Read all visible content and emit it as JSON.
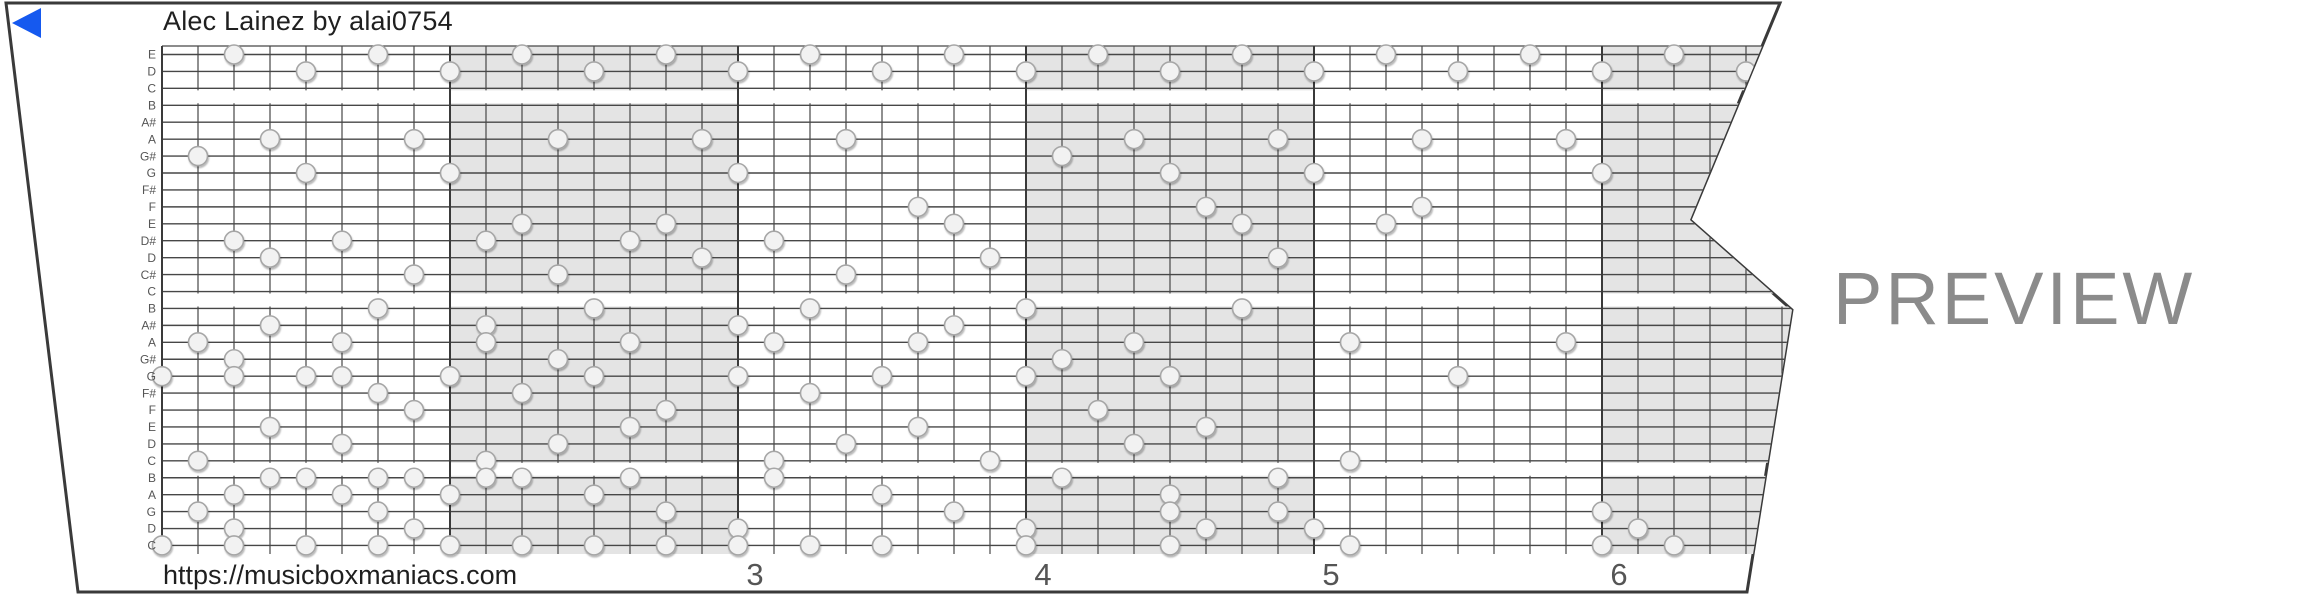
{
  "header": {
    "title": "Alec Lainez by alai0754"
  },
  "footer": {
    "url": "https://musicboxmaniacs.com"
  },
  "watermark": {
    "label": "PREVIEW",
    "color": "#8b8b8b"
  },
  "player": {
    "icon": "play-triangle-icon",
    "color": "#1559ef"
  },
  "strip": {
    "note_labels": [
      "E",
      "D",
      "C",
      "B",
      "A#",
      "A",
      "G#",
      "G",
      "F#",
      "F",
      "E",
      "D#",
      "D",
      "C#",
      "C",
      "B",
      "A#",
      "A",
      "G#",
      "G",
      "F#",
      "F",
      "E",
      "D",
      "C",
      "B",
      "A",
      "G",
      "D",
      "C"
    ],
    "measure_numbers": [
      {
        "label": "3",
        "beat": 16
      },
      {
        "label": "4",
        "beat": 24
      },
      {
        "label": "5",
        "beat": 32
      },
      {
        "label": "6",
        "beat": 40
      }
    ],
    "shaded_measure_starts": [
      8,
      24,
      40
    ],
    "octave_gap_after_rows": [
      2,
      14,
      24
    ],
    "colors": {
      "shade": "#e4e4e4",
      "line": "#474747",
      "measure_line": "#3a3a3a",
      "border": "#3a3a3a",
      "note_fill": "#f2f2f2",
      "note_stroke": "#a6a6a6",
      "label_text": "#555555",
      "number_text": "#555555"
    },
    "notes": [
      [
        0,
        2
      ],
      [
        0,
        6
      ],
      [
        0,
        10
      ],
      [
        0,
        14
      ],
      [
        0,
        18
      ],
      [
        0,
        22
      ],
      [
        0,
        26
      ],
      [
        0,
        30
      ],
      [
        0,
        34
      ],
      [
        0,
        38
      ],
      [
        0,
        42
      ],
      [
        1,
        4
      ],
      [
        1,
        8
      ],
      [
        1,
        12
      ],
      [
        1,
        16
      ],
      [
        1,
        20
      ],
      [
        1,
        24
      ],
      [
        1,
        28
      ],
      [
        1,
        32
      ],
      [
        1,
        36
      ],
      [
        1,
        40
      ],
      [
        1,
        44
      ],
      [
        5,
        3
      ],
      [
        5,
        7
      ],
      [
        5,
        11
      ],
      [
        5,
        15
      ],
      [
        5,
        19
      ],
      [
        5,
        27
      ],
      [
        5,
        31
      ],
      [
        5,
        35
      ],
      [
        5,
        39
      ],
      [
        6,
        1
      ],
      [
        6,
        25
      ],
      [
        7,
        4
      ],
      [
        7,
        8
      ],
      [
        7,
        16
      ],
      [
        7,
        28
      ],
      [
        7,
        32
      ],
      [
        7,
        40
      ],
      [
        9,
        21
      ],
      [
        9,
        29
      ],
      [
        9,
        35
      ],
      [
        10,
        10
      ],
      [
        10,
        14
      ],
      [
        10,
        22
      ],
      [
        10,
        30
      ],
      [
        10,
        34
      ],
      [
        11,
        2
      ],
      [
        11,
        5
      ],
      [
        11,
        9
      ],
      [
        11,
        13
      ],
      [
        11,
        17
      ],
      [
        12,
        3
      ],
      [
        12,
        15
      ],
      [
        12,
        23
      ],
      [
        12,
        31
      ],
      [
        13,
        7
      ],
      [
        13,
        11
      ],
      [
        13,
        19
      ],
      [
        15,
        6
      ],
      [
        15,
        12
      ],
      [
        15,
        18
      ],
      [
        15,
        24
      ],
      [
        15,
        30
      ],
      [
        16,
        3
      ],
      [
        16,
        9
      ],
      [
        16,
        16
      ],
      [
        16,
        22
      ],
      [
        17,
        1
      ],
      [
        17,
        5
      ],
      [
        17,
        9
      ],
      [
        17,
        13
      ],
      [
        17,
        17
      ],
      [
        17,
        21
      ],
      [
        17,
        27
      ],
      [
        17,
        33
      ],
      [
        17,
        39
      ],
      [
        18,
        2
      ],
      [
        18,
        11
      ],
      [
        18,
        25
      ],
      [
        19,
        0
      ],
      [
        19,
        2
      ],
      [
        19,
        4
      ],
      [
        19,
        5
      ],
      [
        19,
        8
      ],
      [
        19,
        12
      ],
      [
        19,
        16
      ],
      [
        19,
        20
      ],
      [
        19,
        24
      ],
      [
        19,
        28
      ],
      [
        19,
        36
      ],
      [
        20,
        6
      ],
      [
        20,
        10
      ],
      [
        20,
        18
      ],
      [
        21,
        7
      ],
      [
        21,
        14
      ],
      [
        21,
        26
      ],
      [
        22,
        3
      ],
      [
        22,
        13
      ],
      [
        22,
        21
      ],
      [
        22,
        29
      ],
      [
        23,
        5
      ],
      [
        23,
        11
      ],
      [
        23,
        19
      ],
      [
        23,
        27
      ],
      [
        24,
        1
      ],
      [
        24,
        9
      ],
      [
        24,
        17
      ],
      [
        24,
        23
      ],
      [
        24,
        33
      ],
      [
        25,
        3
      ],
      [
        25,
        4
      ],
      [
        25,
        6
      ],
      [
        25,
        7
      ],
      [
        25,
        9
      ],
      [
        25,
        10
      ],
      [
        25,
        13
      ],
      [
        25,
        17
      ],
      [
        25,
        25
      ],
      [
        25,
        31
      ],
      [
        26,
        2
      ],
      [
        26,
        5
      ],
      [
        26,
        8
      ],
      [
        26,
        12
      ],
      [
        26,
        20
      ],
      [
        26,
        28
      ],
      [
        27,
        1
      ],
      [
        27,
        6
      ],
      [
        27,
        14
      ],
      [
        27,
        22
      ],
      [
        27,
        28
      ],
      [
        27,
        31
      ],
      [
        27,
        40
      ],
      [
        28,
        2
      ],
      [
        28,
        7
      ],
      [
        28,
        16
      ],
      [
        28,
        24
      ],
      [
        28,
        29
      ],
      [
        28,
        32
      ],
      [
        28,
        41
      ],
      [
        29,
        0
      ],
      [
        29,
        2
      ],
      [
        29,
        4
      ],
      [
        29,
        6
      ],
      [
        29,
        8
      ],
      [
        29,
        10
      ],
      [
        29,
        12
      ],
      [
        29,
        14
      ],
      [
        29,
        16
      ],
      [
        29,
        18
      ],
      [
        29,
        20
      ],
      [
        29,
        24
      ],
      [
        29,
        28
      ],
      [
        29,
        33
      ],
      [
        29,
        40
      ],
      [
        29,
        42
      ]
    ]
  }
}
